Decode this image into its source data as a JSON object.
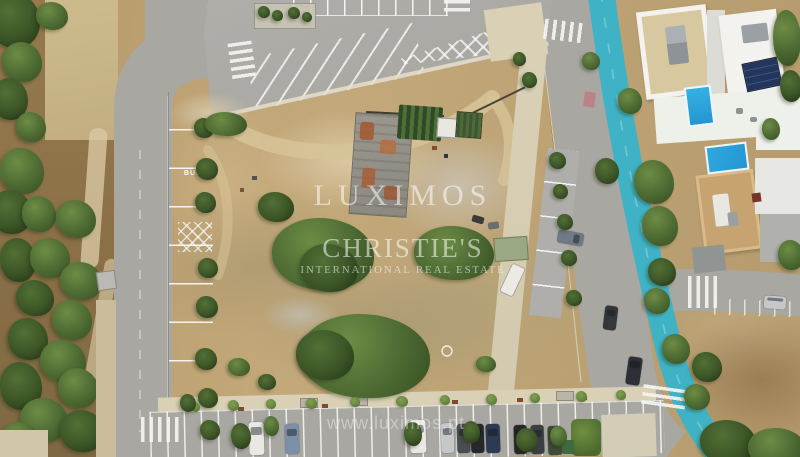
{
  "photo": {
    "watermark": {
      "line1": "LUXIMOS",
      "line2": "CHRISTIE'S",
      "line3": "INTERNATIONAL REAL ESTATE",
      "url": "www.luximos.pt"
    },
    "road_markings": {
      "bus_stop": "BUS"
    },
    "colors": {
      "road": "#a9a7a2",
      "road-dark": "#97958f",
      "parking": "#b4b2ad",
      "dirt": "#bb9e71",
      "dirt-light": "#d7c398",
      "scrub": "#a3976f",
      "rubble": "#c6bfae",
      "sidewalk": "#d9d0b6",
      "soil": "#8d7148",
      "tree-dark": "#3c5526",
      "tree-mid": "#527036",
      "tree-light": "#6e8c44",
      "bike-lane": "#3fb3c5",
      "pool": "#2496d2",
      "villa-white": "#f3f2ee",
      "terrace": "#d8c8a0",
      "roof-tan": "#c7a372",
      "line-white": "#f4f4f0",
      "car-white": "#e9e8e4",
      "car-silver": "#c5c7c9",
      "car-black": "#26282b",
      "car-navy": "#2e3a52",
      "car-steel": "#7b8fa6",
      "car-green": "#3f4a3a",
      "car-gray": "#4a4e52",
      "car-charcoal": "#3b3f43"
    }
  }
}
